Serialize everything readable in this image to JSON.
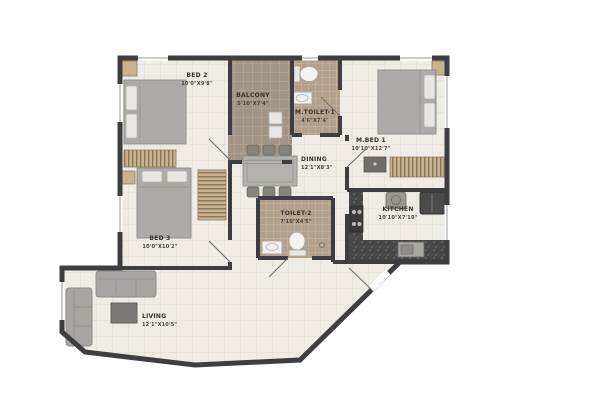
{
  "plan": {
    "type": "apartment-floor-plan",
    "units": "feet-inches"
  },
  "colors": {
    "wall": "#3e3e40",
    "room_floor": "#efece5",
    "balcony_floor": "#a29484",
    "toilet_floor": "#b2a08c",
    "wood": "#c9b28e",
    "wood_stripe": "#87765c",
    "counter_granite": "#474747",
    "furniture_grey": "#acaba8",
    "label_text": "#36302a"
  },
  "rooms": {
    "bed2": {
      "label": "BED 2",
      "dims": "10'0\"X9'8\""
    },
    "balcony": {
      "label": "BALCONY",
      "dims": "5'10\"X7'4\""
    },
    "mtoilet1": {
      "label": "M.TOILET-1",
      "dims": "4'6\"X7'4\""
    },
    "mbed1": {
      "label": "M.BED 1",
      "dims": "10'10\"X12'7\""
    },
    "dining": {
      "label": "DINING",
      "dims": "12'1\"X8'3\""
    },
    "bed3": {
      "label": "BED 3",
      "dims": "10'0\"X10'2\""
    },
    "toilet2": {
      "label": "TOILET-2",
      "dims": "7'10\"X4'5\""
    },
    "kitchen": {
      "label": "KITCHEN",
      "dims": "10'10\"X7'10\""
    },
    "living": {
      "label": "LIVING",
      "dims": "12'1\"X10'5\""
    }
  }
}
